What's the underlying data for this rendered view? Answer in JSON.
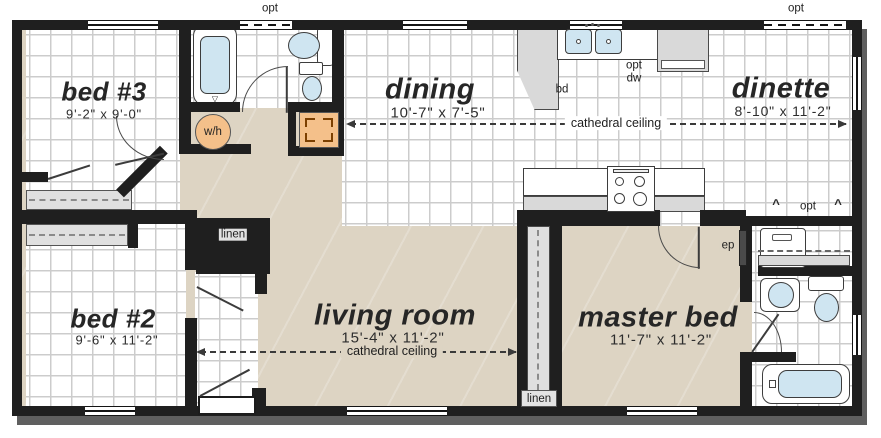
{
  "rooms": {
    "bed3": {
      "name": "bed #3",
      "dims": "9'-2\" x 9'-0\""
    },
    "dining": {
      "name": "dining",
      "dims": "10'-7\" x 7'-5\""
    },
    "dinette": {
      "name": "dinette",
      "dims": "8'-10\" x 11'-2\""
    },
    "bed2": {
      "name": "bed #2",
      "dims": "9'-6\" x 11'-2\""
    },
    "living": {
      "name": "living room",
      "dims": "15'-4\" x 11'-2\"",
      "ceiling": "cathedral ceiling"
    },
    "master": {
      "name": "master bed",
      "dims": "11'-7\" x 11'-2\""
    }
  },
  "annotations": {
    "cathedral_ceiling": "cathedral ceiling",
    "opt": "opt",
    "dw": "dw",
    "bd": "bd",
    "ep": "ep",
    "water_heater": "w/h",
    "linen": "linen"
  },
  "colors": {
    "wall": "#1f1f1f",
    "carpet": "#ddd4c3",
    "tile_background": "#ffffff",
    "tile_line": "#cccccc",
    "counter_gray": "#d9d9d9",
    "fixture_blue": "#cfe5f1",
    "equipment_orange": "#f4c08a"
  }
}
